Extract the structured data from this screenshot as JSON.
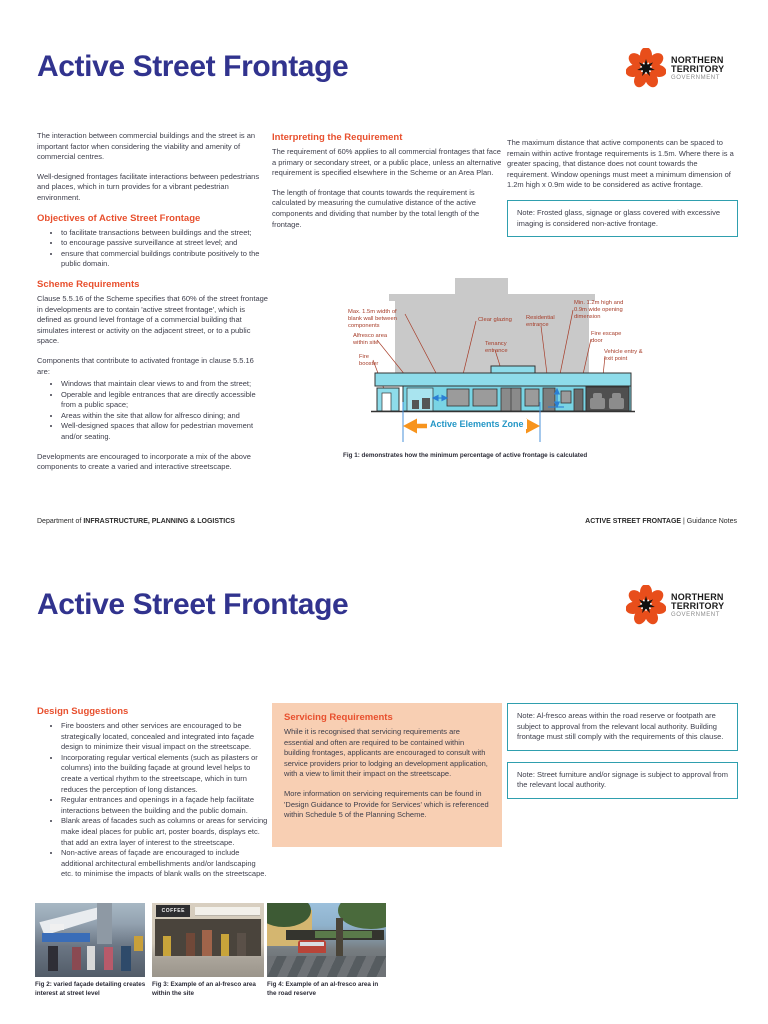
{
  "doc_title": "Active Street Frontage",
  "logo": {
    "org_line1": "NORTHERN",
    "org_line2": "TERRITORY",
    "org_line3": "GOVERNMENT"
  },
  "colors": {
    "title_navy": "#31338e",
    "accent_orange": "#e8502e",
    "note_border_teal": "#2f9fae",
    "servicing_box_bg": "#f8cfb3",
    "diagram_label_red": "#a63c28",
    "zone_text_blue": "#2597c6",
    "zone_arrow_orange": "#f7941d",
    "logo_orange": "#e84e1b"
  },
  "page1": {
    "intro_para1": "The interaction between commercial buildings and the street is an important factor when considering the viability and amenity of commercial centres.",
    "intro_para2": "Well-designed frontages facilitate interactions between pedestrians and places, which in turn provides for a vibrant pedestrian environment.",
    "objectives": {
      "heading": "Objectives of Active Street Frontage",
      "bullets": [
        "to facilitate transactions between buildings and the street;",
        "to encourage passive surveillance at street level; and",
        "ensure that commercial buildings contribute positively to the public domain."
      ]
    },
    "scheme": {
      "heading": "Scheme Requirements",
      "para1": "Clause 5.5.16 of the Scheme specifies that 60% of the street frontage in developments are to contain 'active street frontage', which is defined as ground level frontage of a commercial building that simulates interest or activity on the adjacent street, or to a public space.",
      "para2": "Components that contribute to activated frontage in clause 5.5.16 are:",
      "bullets": [
        "Windows that maintain clear views to and from the street;",
        "Operable and legible entrances that are directly accessible from a public space;",
        "Areas within the site that allow for alfresco dining; and",
        "Well-designed spaces that allow for pedestrian movement and/or seating."
      ],
      "para3": "Developments are encouraged to incorporate a mix of the above components to create a varied and interactive streetscape."
    },
    "interpreting": {
      "heading": "Interpreting the Requirement",
      "para1": "The requirement of 60% applies to all commercial frontages that face a primary or secondary street, or a public place, unless an alternative requirement is specified elsewhere in the Scheme or an Area Plan.",
      "para2": "The length of frontage that counts towards the requirement is calculated by measuring the cumulative distance of the active components and dividing that number by the total length of the frontage."
    },
    "maximum": {
      "para1": "The maximum distance that active components can be spaced to remain within active frontage requirements is 1.5m. Where there is a greater spacing, that distance does not count towards the requirement. Window openings must meet a minimum dimension of 1.2m high x 0.9m wide to be considered as active frontage.",
      "note": "Note: Frosted glass, signage or glass covered with excessive imaging is considered non-active frontage."
    },
    "figure1": {
      "labels": [
        "Max. 1.5m width of blank wall between components",
        "Alfresco area within site",
        "Fire booster",
        "Clear glazing",
        "Tenancy entrance",
        "Residential entrance",
        "Min. 1.2m high and 0.9m wide opening dimension",
        "Fire escape door",
        "Vehicle entry & exit point"
      ],
      "zone_label": "Active Elements Zone",
      "caption": "Fig 1: demonstrates how the minimum percentage of active frontage is calculated"
    },
    "footer": {
      "left_prefix": "Department of",
      "left_department": "INFRASTRUCTURE, PLANNING & LOGISTICS",
      "right_title": "ACTIVE STREET FRONTAGE",
      "right_suffix": "| Guidance Notes"
    }
  },
  "page2": {
    "design": {
      "heading": "Design Suggestions",
      "bullets": [
        "Fire boosters and other services are encouraged to be strategically located, concealed and integrated into façade design to minimize their visual impact on the streetscape.",
        "Incorporating regular vertical elements (such as pilasters or columns) into the building façade at ground level helps to create a vertical rhythm to the streetscape, which in turn reduces the perception of long distances.",
        "Regular entrances and openings in a façade help facilitate interactions between the building and the public domain.",
        "Blank areas of facades such as columns or areas for servicing make ideal places for public art, poster boards, displays etc. that add an extra layer of interest to the streetscape.",
        "Non-active areas of façade are encouraged to include additional architectural embellishments and/or landscaping etc. to minimise the impacts of blank walls on the streetscape."
      ]
    },
    "servicing": {
      "heading": "Servicing Requirements",
      "para1": "While it is recognised that servicing requirements are essential and often are required to be contained within building frontages, applicants are encouraged to consult with service providers prior to lodging an development application, with a view to limit their impact on the streetscape.",
      "para2": "More information on servicing requirements can be found in 'Design Guidance to Provide for Services' which is referenced within Schedule 5 of the Planning Scheme."
    },
    "note1": "Note: Al-fresco areas within the road reserve or footpath are subject to approval from the relevant local authority. Building frontage must still comply with the requirements of this clause.",
    "note2": "Note: Street furniture and/or signage is subject to approval from the relevant local authority.",
    "figures": [
      {
        "caption": "Fig 2: varied façade detailing creates interest at street level"
      },
      {
        "caption": "Fig 3: Example of an al-fresco area within the site",
        "sign": "COFFEE"
      },
      {
        "caption": "Fig 4: Example of an al-fresco area in the road reserve"
      }
    ]
  }
}
